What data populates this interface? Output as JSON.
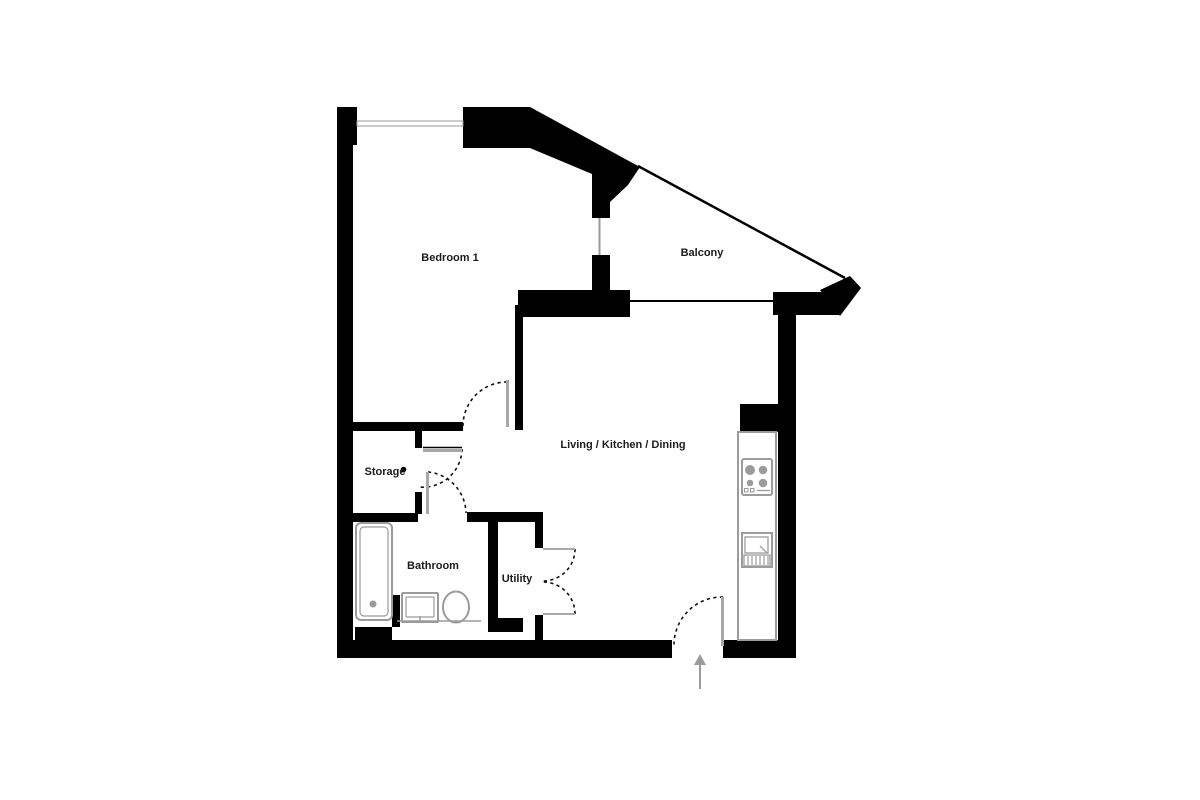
{
  "meta": {
    "title": "Apartment floor plan"
  },
  "colors": {
    "wall": "#000000",
    "door_leaf": "#a8a8a8",
    "window": "#9a9a9a",
    "window_fill": "#ffffff",
    "fixture": "#9b9b9b",
    "dash": "#111111",
    "arrow": "#9b9b9b",
    "label": "#1c1c1c"
  },
  "rooms": [
    {
      "id": "bedroom-1",
      "label": "Bedroom 1",
      "x": 450,
      "y": 261,
      "size": 11
    },
    {
      "id": "balcony",
      "label": "Balcony",
      "x": 702,
      "y": 256,
      "size": 11
    },
    {
      "id": "living-kitchen-dining",
      "label": "Living / Kitchen / Dining",
      "x": 623,
      "y": 448,
      "size": 11
    },
    {
      "id": "storage",
      "label": "Storage",
      "x": 385,
      "y": 475,
      "size": 11
    },
    {
      "id": "bathroom",
      "label": "Bathroom",
      "x": 433,
      "y": 569,
      "size": 11
    },
    {
      "id": "utility",
      "label": "Utility",
      "x": 517,
      "y": 582,
      "size": 11
    }
  ],
  "geometry": {
    "wall_rects": [
      {
        "name": "left-wall-top-block",
        "x": 337,
        "y": 107,
        "w": 20,
        "h": 38
      },
      {
        "name": "left-outer-wall",
        "x": 337,
        "y": 140,
        "w": 16,
        "h": 518
      },
      {
        "name": "top-wall",
        "x": 463,
        "y": 107,
        "w": 67,
        "h": 41
      },
      {
        "name": "balcony-door-upper-pier",
        "x": 592,
        "y": 174,
        "w": 18,
        "h": 44
      },
      {
        "name": "balcony-door-lower-pier",
        "x": 592,
        "y": 255,
        "w": 18,
        "h": 37
      },
      {
        "name": "balcony-wall-left",
        "x": 518,
        "y": 290,
        "w": 112,
        "h": 27
      },
      {
        "name": "balcony-wall-right",
        "x": 773,
        "y": 292,
        "w": 67,
        "h": 23
      },
      {
        "name": "bedroom-living-divider",
        "x": 515,
        "y": 305,
        "w": 8,
        "h": 125
      },
      {
        "name": "bedroom-bottom-wall",
        "x": 353,
        "y": 422,
        "w": 110,
        "h": 9
      },
      {
        "name": "storage-wall-upper-stub",
        "x": 415,
        "y": 431,
        "w": 7,
        "h": 17
      },
      {
        "name": "storage-wall-lower-stub",
        "x": 415,
        "y": 492,
        "w": 7,
        "h": 22
      },
      {
        "name": "bathroom-top-wall",
        "x": 353,
        "y": 513,
        "w": 65,
        "h": 9
      },
      {
        "name": "utility-top-wall",
        "x": 467,
        "y": 512,
        "w": 76,
        "h": 10
      },
      {
        "name": "utility-left-wall",
        "x": 488,
        "y": 522,
        "w": 10,
        "h": 98
      },
      {
        "name": "utility-bottom-wall",
        "x": 488,
        "y": 618,
        "w": 35,
        "h": 14
      },
      {
        "name": "utility-right-wall-upper",
        "x": 535,
        "y": 522,
        "w": 8,
        "h": 26
      },
      {
        "name": "utility-right-wall-lower",
        "x": 535,
        "y": 615,
        "w": 8,
        "h": 27
      },
      {
        "name": "kitchen-stub-wall",
        "x": 740,
        "y": 404,
        "w": 56,
        "h": 28
      },
      {
        "name": "right-outer-wall",
        "x": 778,
        "y": 315,
        "w": 18,
        "h": 343
      },
      {
        "name": "bottom-wall-left",
        "x": 337,
        "y": 640,
        "w": 335,
        "h": 18
      },
      {
        "name": "bottom-wall-right",
        "x": 723,
        "y": 640,
        "w": 73,
        "h": 18
      },
      {
        "name": "bathtub-pier",
        "x": 355,
        "y": 627,
        "w": 37,
        "h": 13
      },
      {
        "name": "tub-basin-stub",
        "x": 392,
        "y": 595,
        "w": 8,
        "h": 32
      }
    ],
    "wall_polygons": [
      {
        "name": "diagonal-wall-band",
        "points": "530,107 640,167 628,185 592,174 530,148"
      },
      {
        "name": "diagonal-wall-wedge",
        "points": "610,176 628,185 610,202"
      },
      {
        "name": "balcony-corner-block",
        "points": "820,290 850,276 861,288 840,316"
      }
    ],
    "wall_lines": [
      {
        "name": "balcony-railing",
        "x1": 638,
        "y1": 166,
        "x2": 845,
        "y2": 278,
        "w": 2.5
      },
      {
        "name": "balcony-bottom-edge",
        "x1": 630,
        "y1": 301,
        "x2": 774,
        "y2": 301,
        "w": 2
      },
      {
        "name": "storage-door-header",
        "x1": 423,
        "y1": 447.5,
        "x2": 462,
        "y2": 447.5,
        "w": 1.5
      }
    ],
    "windows": [
      {
        "name": "bedroom-window",
        "type": "rect",
        "x": 357,
        "y": 121,
        "w": 106,
        "h": 5
      },
      {
        "name": "balcony-slider-window",
        "type": "line",
        "x1": 599.5,
        "y1": 218,
        "x2": 599.5,
        "y2": 255,
        "w": 2
      }
    ],
    "doors": [
      {
        "name": "bedroom-door",
        "leaf": {
          "x": 506,
          "y": 380,
          "w": 3,
          "h": 47
        },
        "arc": "M463,426 A44,44 0 0 1 507,382"
      },
      {
        "name": "storage-door",
        "leaf": {
          "x": 423,
          "y": 449,
          "w": 39,
          "h": 3
        },
        "arc": "M462,449 A39,39 0 0 1 419,487"
      },
      {
        "name": "bathroom-door",
        "leaf": {
          "x": 426,
          "y": 472,
          "w": 3,
          "h": 42
        },
        "arc": "M428,472 A42,42 0 0 1 466,513"
      },
      {
        "name": "entrance-door",
        "leaf": {
          "x": 721,
          "y": 597,
          "w": 3,
          "h": 49
        },
        "arc": "M723,597 A48,48 0 0 0 674,645"
      },
      {
        "name": "utility-door-top",
        "leaf_line": {
          "x1": 543,
          "y1": 549,
          "x2": 575,
          "y2": 549
        },
        "arc": "M575,549 A32,32 0 0 1 543,581"
      },
      {
        "name": "utility-door-bottom",
        "leaf_line": {
          "x1": 543,
          "y1": 614,
          "x2": 575,
          "y2": 614
        },
        "arc": "M575,614 A32,32 0 0 0 543,582"
      }
    ],
    "dots": [
      {
        "name": "door-stop-dot",
        "cx": 403.5,
        "cy": 469.5,
        "r": 2.8
      }
    ],
    "fixtures": [
      {
        "t": "rect",
        "n": "bathtub-outer",
        "x": 356,
        "y": 523,
        "w": 36,
        "h": 97,
        "rx": 5,
        "sw": 2
      },
      {
        "t": "rect",
        "n": "bathtub-inner",
        "x": 360,
        "y": 527,
        "w": 28,
        "h": 89,
        "rx": 4,
        "sw": 1.2
      },
      {
        "t": "dot",
        "n": "bathtub-drain",
        "cx": 373,
        "cy": 604,
        "r": 3.5
      },
      {
        "t": "rect",
        "n": "basin-outer",
        "x": 402,
        "y": 593,
        "w": 36,
        "h": 29,
        "rx": 1,
        "sw": 2
      },
      {
        "t": "rect",
        "n": "basin-inner",
        "x": 406,
        "y": 597,
        "w": 28,
        "h": 20,
        "rx": 1,
        "sw": 1.2
      },
      {
        "t": "line",
        "n": "basin-tap",
        "x1": 420,
        "y1": 616,
        "x2": 420,
        "y2": 622,
        "sw": 1.5
      },
      {
        "t": "ellipse",
        "n": "toilet-bowl",
        "cx": 456,
        "cy": 607,
        "rx": 13,
        "ry": 15.5,
        "sw": 2
      },
      {
        "t": "line",
        "n": "bathroom-fixture-line",
        "x1": 397,
        "y1": 621,
        "x2": 481,
        "y2": 621,
        "sw": 1.5
      },
      {
        "t": "rect",
        "n": "kitchen-counter",
        "x": 738,
        "y": 432,
        "w": 38,
        "h": 208,
        "sw": 2,
        "fill": "#ffffff"
      },
      {
        "t": "rect",
        "n": "hob-outline",
        "x": 742,
        "y": 459,
        "w": 30,
        "h": 36,
        "rx": 2,
        "sw": 2
      },
      {
        "t": "dot",
        "n": "hob-burner-tl",
        "cx": 750,
        "cy": 470,
        "r": 5
      },
      {
        "t": "dot",
        "n": "hob-burner-tr",
        "cx": 763,
        "cy": 470,
        "r": 4.3
      },
      {
        "t": "dot",
        "n": "hob-burner-bl",
        "cx": 750,
        "cy": 483,
        "r": 3.3
      },
      {
        "t": "dot",
        "n": "hob-burner-br",
        "cx": 763,
        "cy": 483,
        "r": 4.3
      },
      {
        "t": "rect",
        "n": "hob-control-1",
        "x": 744.5,
        "y": 488.5,
        "w": 3.5,
        "h": 3.5,
        "sw": 1
      },
      {
        "t": "rect",
        "n": "hob-control-2",
        "x": 750.5,
        "y": 488.5,
        "w": 3.5,
        "h": 3.5,
        "sw": 1
      },
      {
        "t": "line",
        "n": "hob-control-line",
        "x1": 757,
        "y1": 490.5,
        "x2": 770,
        "y2": 490.5,
        "sw": 1.3
      },
      {
        "t": "rect",
        "n": "kitchen-sink-outer",
        "x": 742,
        "y": 533,
        "w": 30,
        "h": 34,
        "sw": 2
      },
      {
        "t": "rect",
        "n": "kitchen-sink-bowl",
        "x": 745,
        "y": 537,
        "w": 23,
        "h": 16,
        "sw": 1.3
      },
      {
        "t": "line",
        "n": "kitchen-sink-diag",
        "x1": 760,
        "y1": 546,
        "x2": 767,
        "y2": 553,
        "sw": 1.3
      },
      {
        "t": "rect",
        "n": "kitchen-sink-drainer",
        "x": 744,
        "y": 555,
        "w": 26,
        "h": 11,
        "sw": 1.3
      },
      {
        "t": "line",
        "n": "drainer-bar-1",
        "x1": 748,
        "y1": 556,
        "x2": 748,
        "y2": 565,
        "sw": 1.2
      },
      {
        "t": "line",
        "n": "drainer-bar-2",
        "x1": 752,
        "y1": 556,
        "x2": 752,
        "y2": 565,
        "sw": 1.2
      },
      {
        "t": "line",
        "n": "drainer-bar-3",
        "x1": 756,
        "y1": 556,
        "x2": 756,
        "y2": 565,
        "sw": 1.2
      },
      {
        "t": "line",
        "n": "drainer-bar-4",
        "x1": 760,
        "y1": 556,
        "x2": 760,
        "y2": 565,
        "sw": 1.2
      },
      {
        "t": "line",
        "n": "drainer-bar-5",
        "x1": 764,
        "y1": 556,
        "x2": 764,
        "y2": 565,
        "sw": 1.2
      },
      {
        "t": "line",
        "n": "drainer-bar-6",
        "x1": 768,
        "y1": 556,
        "x2": 768,
        "y2": 565,
        "sw": 1.2
      }
    ],
    "entrance_arrow": {
      "line": {
        "x1": 700,
        "y1": 689,
        "x2": 700,
        "y2": 662
      },
      "head_points": "700,654 694,665 706,665"
    }
  }
}
